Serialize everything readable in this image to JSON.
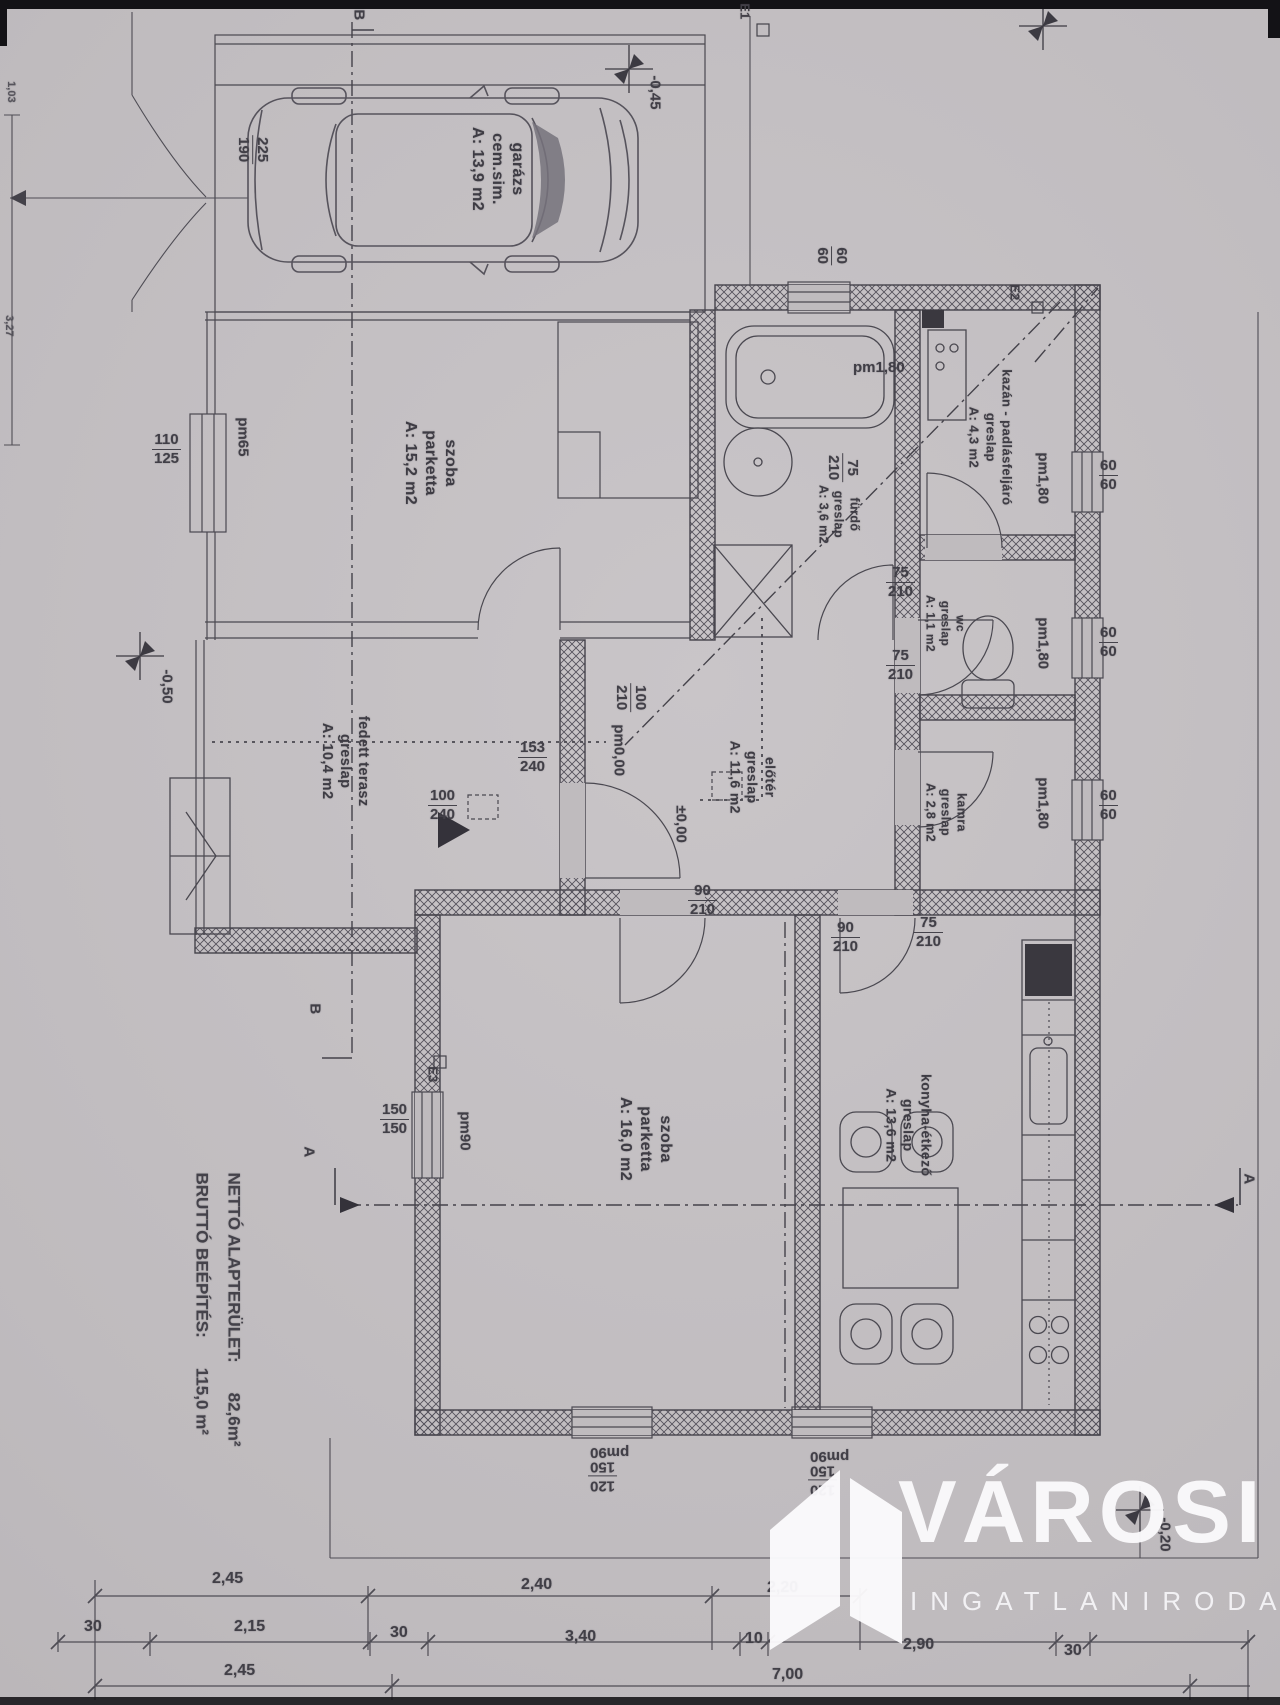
{
  "watermark": {
    "brand": "VÁROSI",
    "subtitle": "INGATLANIRODA"
  },
  "summary": {
    "gross_label": "BRUTTÓ BEÉPÍTÉS:",
    "gross_value": "115,0 m²",
    "net_label": "NETTÓ ALAPTERÜLET:",
    "net_value": "82,6m²"
  },
  "rooms": {
    "garazs": {
      "name": "garázs",
      "floor": "cem.sim.",
      "area": "A: 13,9 m2"
    },
    "szoba1": {
      "name": "szoba",
      "floor": "parketta",
      "area": "A: 15,2 m2"
    },
    "terasz": {
      "name": "fedett terasz",
      "floor": "greslap",
      "area": "A: 10,4 m2"
    },
    "furdo": {
      "name": "fürdő",
      "floor": "greslap",
      "area": "A: 3,6 m2"
    },
    "kazan": {
      "name": "kazán - padlásfeljáró",
      "floor": "greslap",
      "area": "A: 4,3 m2"
    },
    "wc": {
      "name": "wc",
      "floor": "greslap",
      "area": "A: 1,1 m2"
    },
    "kamra": {
      "name": "kamra",
      "floor": "greslap",
      "area": "A: 2,8 m2"
    },
    "eloter": {
      "name": "előtér",
      "floor": "greslap",
      "area": "A: 11,6 m2"
    },
    "szoba2": {
      "name": "szoba",
      "floor": "parketta",
      "area": "A: 16,0 m2"
    },
    "konyha": {
      "name": "konyha-étkező",
      "floor": "greslap",
      "area": "A: 13,6 m2"
    }
  },
  "levels": {
    "terrace": "-0,50",
    "garage_front": "-0,45",
    "plot_corner": "-0,20",
    "entry": "±0,00",
    "entry_sill": "pm0,00"
  },
  "markers": {
    "e1": "E1",
    "e2": "E2",
    "e3": "E3",
    "section_a": "A",
    "section_b": "B"
  },
  "dims": {
    "garage_door": {
      "a": "225",
      "b": "190"
    },
    "plot_left_upper": "1,03",
    "plot_left_lower": "3,27",
    "szoba1_window": {
      "a": "110",
      "b": "125"
    },
    "szoba1_window_sill": "pm65",
    "szoba1_door": {
      "a": "100",
      "b": "210"
    },
    "terasz_pass": {
      "a": "153",
      "b": "240"
    },
    "terasz_open": {
      "a": "100",
      "b": "240"
    },
    "front_door": {
      "a": "90",
      "b": "210"
    },
    "furdo_window": {
      "a": "60",
      "b": "60"
    },
    "furdo_window_sill": "pm1,80",
    "furdo_door": {
      "a": "75",
      "b": "210"
    },
    "kazan_door": {
      "a": "75",
      "b": "210"
    },
    "kazan_window_sill": "pm1,80",
    "wc_door": {
      "a": "75",
      "b": "210"
    },
    "wc_window_sill": "pm1,80",
    "kamra_window_sill": "pm1,80",
    "right_window_1": {
      "a": "60",
      "b": "60"
    },
    "right_window_2": {
      "a": "60",
      "b": "60"
    },
    "right_window_3": {
      "a": "60",
      "b": "60"
    },
    "konyha_door_a": {
      "a": "90",
      "b": "210"
    },
    "konyha_door_b": {
      "a": "75",
      "b": "210"
    },
    "szoba2_window": {
      "a": "150",
      "b": "150"
    },
    "szoba2_window_sill": "pm90",
    "bottom_window_1": {
      "a": "120",
      "b": "150"
    },
    "bottom_window_1_sill": "pm90",
    "bottom_window_2": {
      "a": "120",
      "b": "150"
    },
    "bottom_window_2_sill": "pm90"
  },
  "dim_rows": {
    "row1": [
      "2,45",
      "2,40",
      "2,20"
    ],
    "row2": [
      "30",
      "2,15",
      "30",
      "3,40",
      "10",
      "2,90",
      "30"
    ],
    "row3": [
      "2,45",
      "7,00"
    ]
  }
}
